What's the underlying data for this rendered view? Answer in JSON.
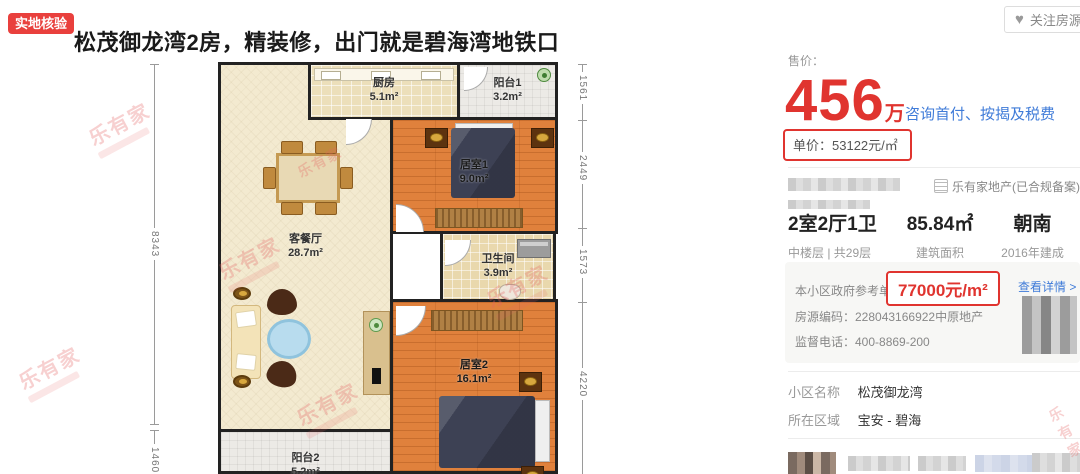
{
  "header": {
    "badge_label": "实地核验",
    "title": "松茂御龙湾2房，精装修，出门就是碧海湾地铁口",
    "follow_button": {
      "icon": "heart-icon",
      "label": "关注房源"
    }
  },
  "floorplan": {
    "watermark_text": "乐有家",
    "rooms": [
      {
        "name": "厨房",
        "area": "5.1m²"
      },
      {
        "name": "阳台1",
        "area": "3.2m²"
      },
      {
        "name": "居室1",
        "area": "9.0m²"
      },
      {
        "name": "客餐厅",
        "area": "28.7m²"
      },
      {
        "name": "卫生间",
        "area": "3.9m²"
      },
      {
        "name": "居室2",
        "area": "16.1m²"
      },
      {
        "name": "阳台2",
        "area": "5.2m²"
      }
    ],
    "dimensions_left": [
      "8343",
      "1460"
    ],
    "dimensions_right": [
      "1561",
      "2449",
      "1573",
      "4220"
    ]
  },
  "pricing": {
    "sale_label": "售价：",
    "amount": "456",
    "amount_unit": "万",
    "consult_link": "咨询首付、按揭及税费",
    "unit_price": "单价：53122元/㎡"
  },
  "agency": {
    "label": "乐有家地产(已合规备案)",
    "icon": "building-list-icon"
  },
  "stats": [
    {
      "value": "2室2厅1卫",
      "label": "中楼层 | 共29层"
    },
    {
      "value": "85.84㎡",
      "label": "建筑面积"
    },
    {
      "value": "朝南",
      "label": "2016年建成"
    }
  ],
  "gov_price": {
    "label": "本小区政府参考单价:",
    "value": "77000元/m²",
    "detail_link": "查看详情 >",
    "listing_code": "房源编码：228043166922中原地产",
    "hotline": "监督电话：400-8869-200"
  },
  "community": {
    "name_label": "小区名称",
    "name_value": "松茂御龙湾",
    "district_label": "所在区域",
    "district_value": "宝安 - 碧海"
  },
  "colors": {
    "accent_red": "#e9403d",
    "price_red": "#e0342f",
    "link_blue": "#3f7bd8"
  }
}
